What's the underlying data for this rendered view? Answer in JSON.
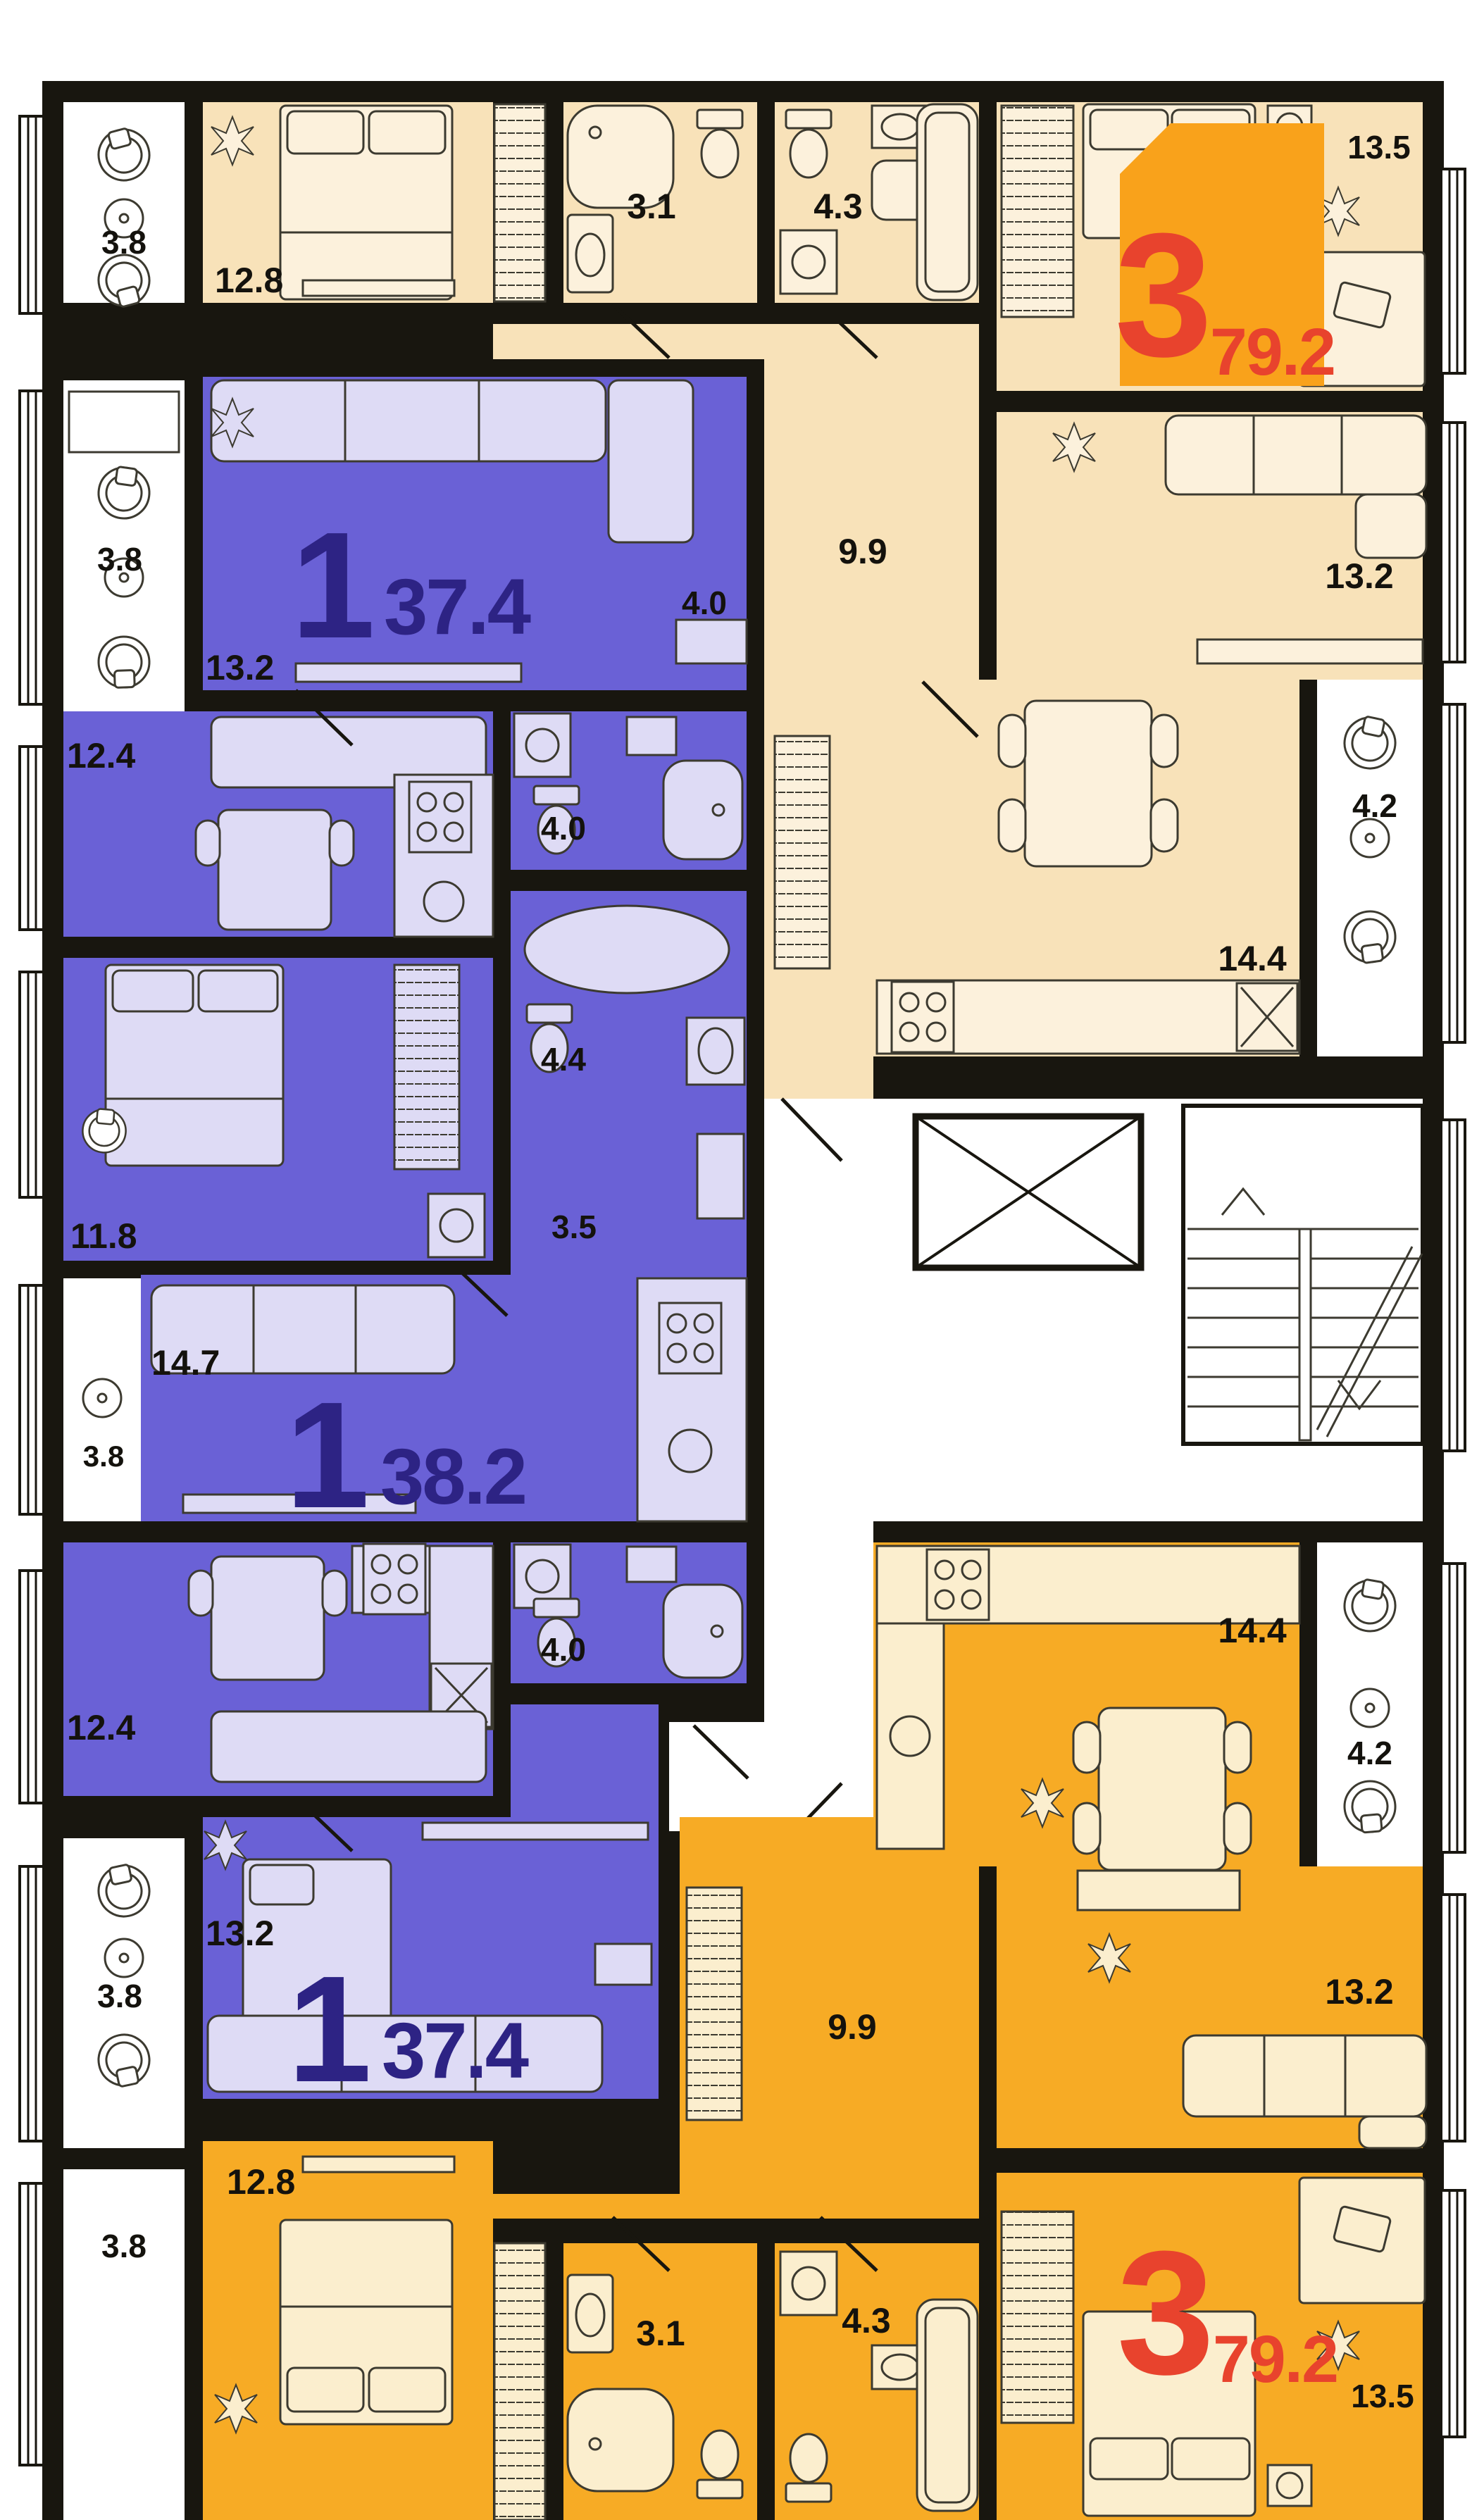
{
  "palette": {
    "wall": "#18160F",
    "cream_room": "#F8E2B9",
    "cream_furniture": "#FCF1DC",
    "orange_room": "#F7AB25",
    "orange_furniture": "#FBEECE",
    "purple_room": "#6A61D6",
    "purple_furniture": "#DEDBF5",
    "indigo_text": "#2D2384",
    "red_text": "#E8432D",
    "badge_orange": "#F9A21B",
    "white": "#FFFFFF"
  },
  "apartments": {
    "top3": {
      "type_label": "3",
      "total_area": "79.2",
      "rooms": {
        "balcony_left": "3.8",
        "bedroom_left": "12.8",
        "bath_small": "3.1",
        "bath_big": "4.3",
        "bedroom_right": "13.5",
        "hallway": "9.9",
        "living": "13.2",
        "kitchen": "14.4",
        "balcony_right": "4.2"
      }
    },
    "one_top": {
      "type_label": "1",
      "total_area": "37.4",
      "rooms": {
        "balcony": "3.8",
        "living": "13.2",
        "hall": "4.0",
        "kitchen": "12.4",
        "bath": "4.0"
      }
    },
    "one_middle": {
      "type_label": "1",
      "total_area": "38.2",
      "rooms": {
        "bedroom": "11.8",
        "bath": "4.4",
        "hall": "3.5",
        "living": "14.7",
        "balcony": "3.8"
      }
    },
    "one_bottom": {
      "type_label": "1",
      "total_area": "37.4",
      "rooms": {
        "kitchen": "12.4",
        "bath": "4.0",
        "living": "13.2",
        "balcony": "3.8"
      }
    },
    "bottom3": {
      "type_label": "3",
      "total_area": "79.2",
      "rooms": {
        "kitchen": "14.4",
        "balcony_right": "4.2",
        "hallway": "9.9",
        "living": "13.2",
        "bedroom_left": "12.8",
        "balcony_left": "3.8",
        "bath_small": "3.1",
        "bath_big": "4.3",
        "bedroom_right": "13.5"
      }
    }
  }
}
